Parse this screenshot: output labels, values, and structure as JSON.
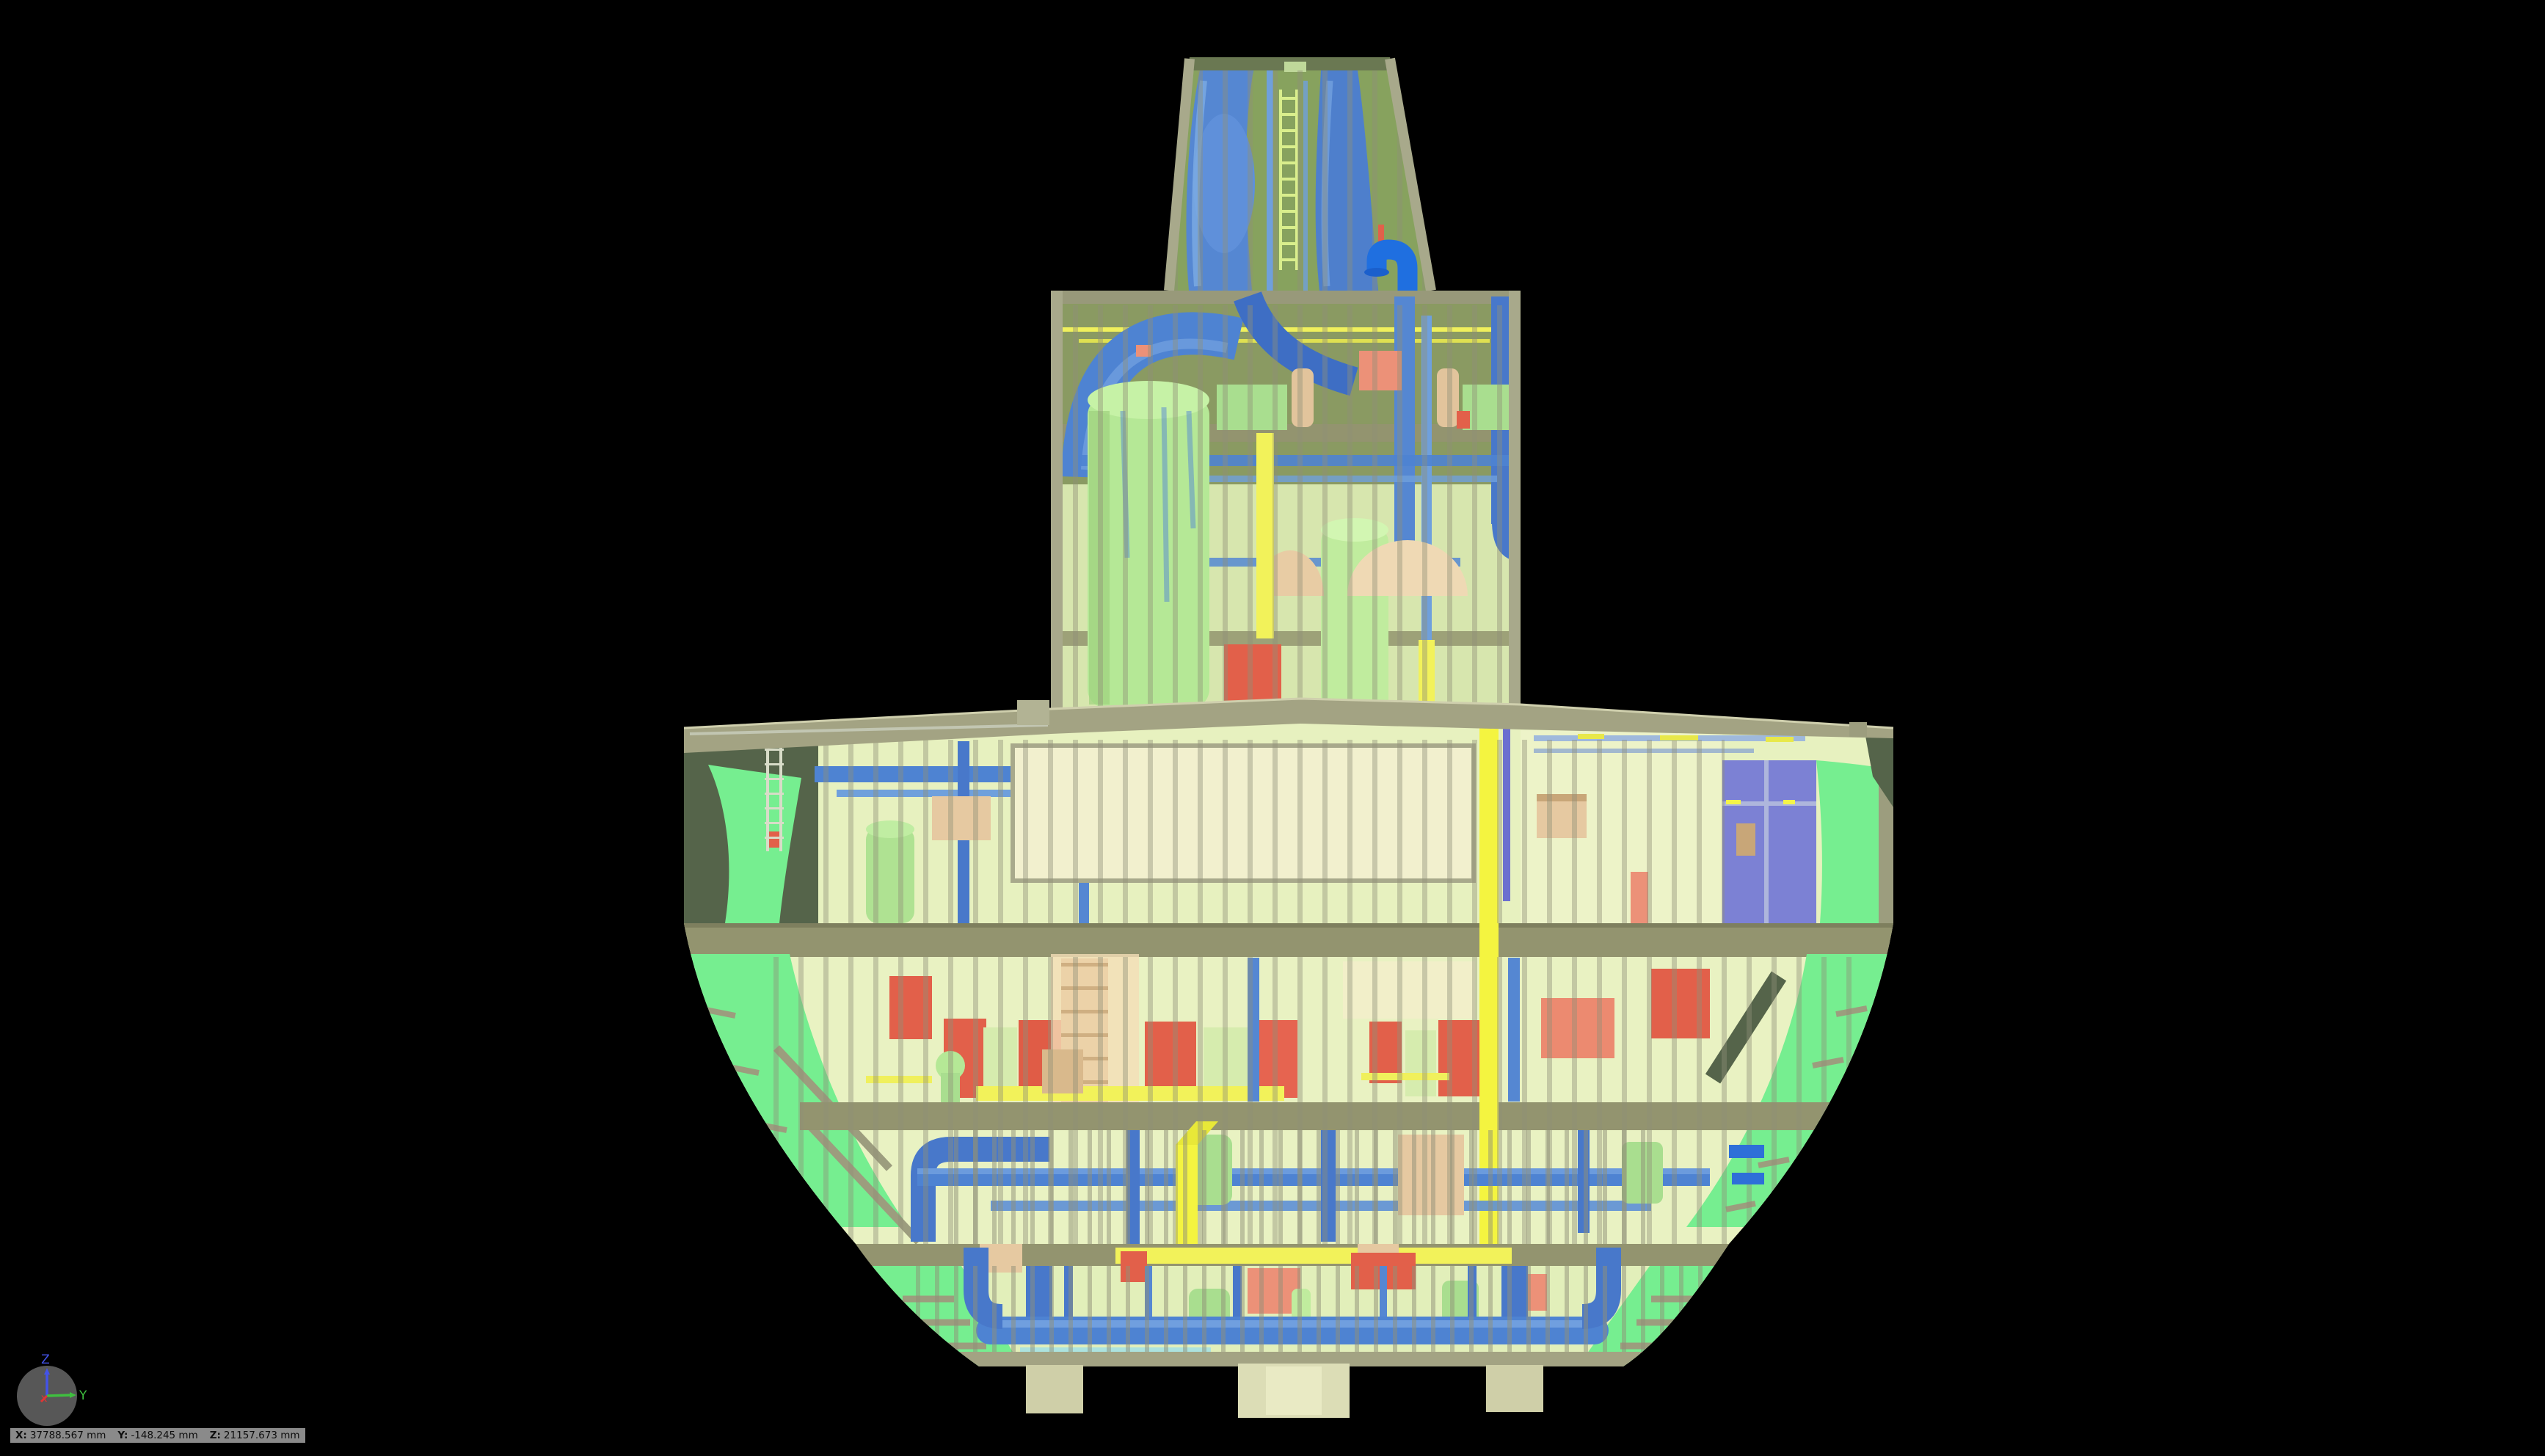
{
  "viewport": {
    "background": "#000000",
    "kind_hint": "3D model viewport"
  },
  "status_bar": {
    "x_label": "X:",
    "x_value": "37788.567 mm",
    "y_label": "Y:",
    "y_value": "-148.245 mm",
    "z_label": "Z:",
    "z_value": "21157.673 mm"
  },
  "nav_ball": {
    "z_axis_label": "Z",
    "y_axis_label": "Y",
    "x_axis_label": "x",
    "z_color": "#4353e8",
    "y_color": "#3fbf3f",
    "x_color": "#e03535",
    "ball_color": "#575757"
  },
  "colors": {
    "status-bar-bg": "#8a8a8a",
    "status-bar-text": "#0d0d0d",
    "hull_shell_green": "#76ee90",
    "shell_dark_olive": "#55644a",
    "deck_khaki": "#a3a383",
    "deck_band_olive": "#93946f",
    "bulkhead_pale": "#e9f2c1",
    "void_cream": "#f2f0ce",
    "pipe_blue": "#4e83d2",
    "pipe_blue_dark": "#3a6cc0",
    "pipe_blue_bright": "#1f6fe0",
    "pipe_steel": "#9fb9dc",
    "vessel_green": "#b5e896",
    "machinery_green": "#a9de8f",
    "equipment_red": "#e2604a",
    "equipment_salmon": "#ec9178",
    "pipe_yellow": "#f2f25a",
    "trunk_yellow": "#f4f440",
    "equipment_tan": "#e6c9a1",
    "room_purple": "#7c81d4",
    "frame_gray": "#8f9078",
    "funnel_interior_green": "#87a25e",
    "house_interior_olive": "#8a9a62",
    "keel_block": "#cfcfa8"
  }
}
